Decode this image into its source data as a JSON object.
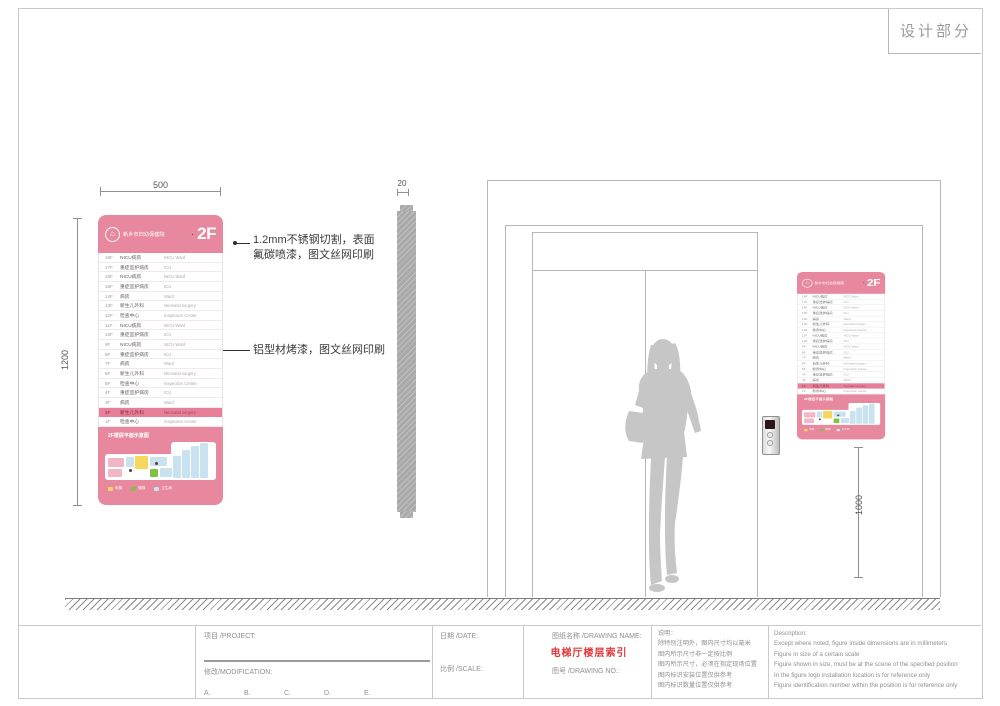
{
  "page": {
    "corner_title": "设计部分"
  },
  "sign": {
    "header": {
      "hospital_name": "新乡市妇幼保健院",
      "floor_label": "2F",
      "separator": "·",
      "logo_icon": "house-icon"
    },
    "rows": [
      {
        "floor": "18F",
        "zh": "NICU病房",
        "en": "NICU Ward",
        "highlight": false
      },
      {
        "floor": "17F",
        "zh": "重症监护病房",
        "en": "ICU",
        "highlight": false
      },
      {
        "floor": "16F",
        "zh": "NICU病房",
        "en": "NICU Ward",
        "highlight": false
      },
      {
        "floor": "15F",
        "zh": "重症监护病房",
        "en": "ICU",
        "highlight": false
      },
      {
        "floor": "14F",
        "zh": "病房",
        "en": "Ward",
        "highlight": false
      },
      {
        "floor": "13F",
        "zh": "新生儿外科",
        "en": "Neonatal surgery",
        "highlight": false
      },
      {
        "floor": "12F",
        "zh": "检查中心",
        "en": "Inspection Center",
        "highlight": false
      },
      {
        "floor": "11F",
        "zh": "NICU病房",
        "en": "NICU Ward",
        "highlight": false
      },
      {
        "floor": "10F",
        "zh": "重症监护病房",
        "en": "ICU",
        "highlight": false
      },
      {
        "floor": "9F",
        "zh": "NICU病房",
        "en": "NICU Ward",
        "highlight": false
      },
      {
        "floor": "8F",
        "zh": "重症监护病房",
        "en": "ICU",
        "highlight": false
      },
      {
        "floor": "7F",
        "zh": "病房",
        "en": "Ward",
        "highlight": false
      },
      {
        "floor": "6F",
        "zh": "新生儿外科",
        "en": "Neonatal surgery",
        "highlight": false
      },
      {
        "floor": "5F",
        "zh": "检查中心",
        "en": "Inspection Center",
        "highlight": false
      },
      {
        "floor": "4F",
        "zh": "重症监护病房",
        "en": "ICU",
        "highlight": false
      },
      {
        "floor": "3F",
        "zh": "病房",
        "en": "Ward",
        "highlight": false
      },
      {
        "floor": "2F",
        "zh": "新生儿外科",
        "en": "Neonatal surgery",
        "highlight": true
      },
      {
        "floor": "1F",
        "zh": "检查中心",
        "en": "Inspection Center",
        "highlight": false
      }
    ],
    "map": {
      "title": "2F楼层平面示意图",
      "legend": [
        {
          "label": "电梯",
          "color": "#f6d75d"
        },
        {
          "label": "楼梯",
          "color": "#7fc242"
        },
        {
          "label": "卫生间",
          "color": "#c9e2f0"
        }
      ],
      "palette": {
        "blue": "#c9e2f0",
        "yellow": "#f6d75d",
        "pink": "#f2b6c5",
        "green": "#7fc242"
      }
    }
  },
  "annotations": {
    "steel_line1": "1.2mm不锈钢切割，表面",
    "steel_line2": "氟碳喷漆，图文丝网印刷",
    "aluminum": "铝型材烤漆，图文丝网印刷"
  },
  "dimensions": {
    "sign_width": "500",
    "sign_height": "1200",
    "panel_thickness": "20",
    "install_height": "1000"
  },
  "titleblock": {
    "project_label": "项目 /PROJECT:",
    "modification_label": "修改/MODIFICATION:",
    "revisions": [
      "A.",
      "B.",
      "C.",
      "D.",
      "E."
    ],
    "date_label": "日期 /DATE:",
    "scale_label": "比例 /SCALE:",
    "drawing_name_label": "图纸名称 /DRAWING NAME:",
    "drawing_name": "电梯厅楼层索引",
    "drawing_no_label": "图号 /DRAWING NO.:",
    "notes_zh": [
      "说明：",
      "除特别注明外，图内尺寸均以毫米",
      "图内所示尺寸非一定按比例",
      "图内所示尺寸，必须在指定现场位置",
      "图内标识安装位置仅供参考",
      "图内标识数量位置仅供参考"
    ],
    "notes_en": [
      "Description:",
      "Except where noted, figure inside dimensions are in millimeters",
      "Figure in size of a certain scale",
      "Figure shown in size, must be at the scene of the specified position",
      "In the figure logo installation location is for reference only",
      "Figure identification number within the position is for reference only"
    ]
  },
  "colors": {
    "sign_pink": "#e8889e",
    "highlight_pink": "#e87f98",
    "drawing_name_red": "#e0393b",
    "line_gray": "#b7b7b7"
  }
}
